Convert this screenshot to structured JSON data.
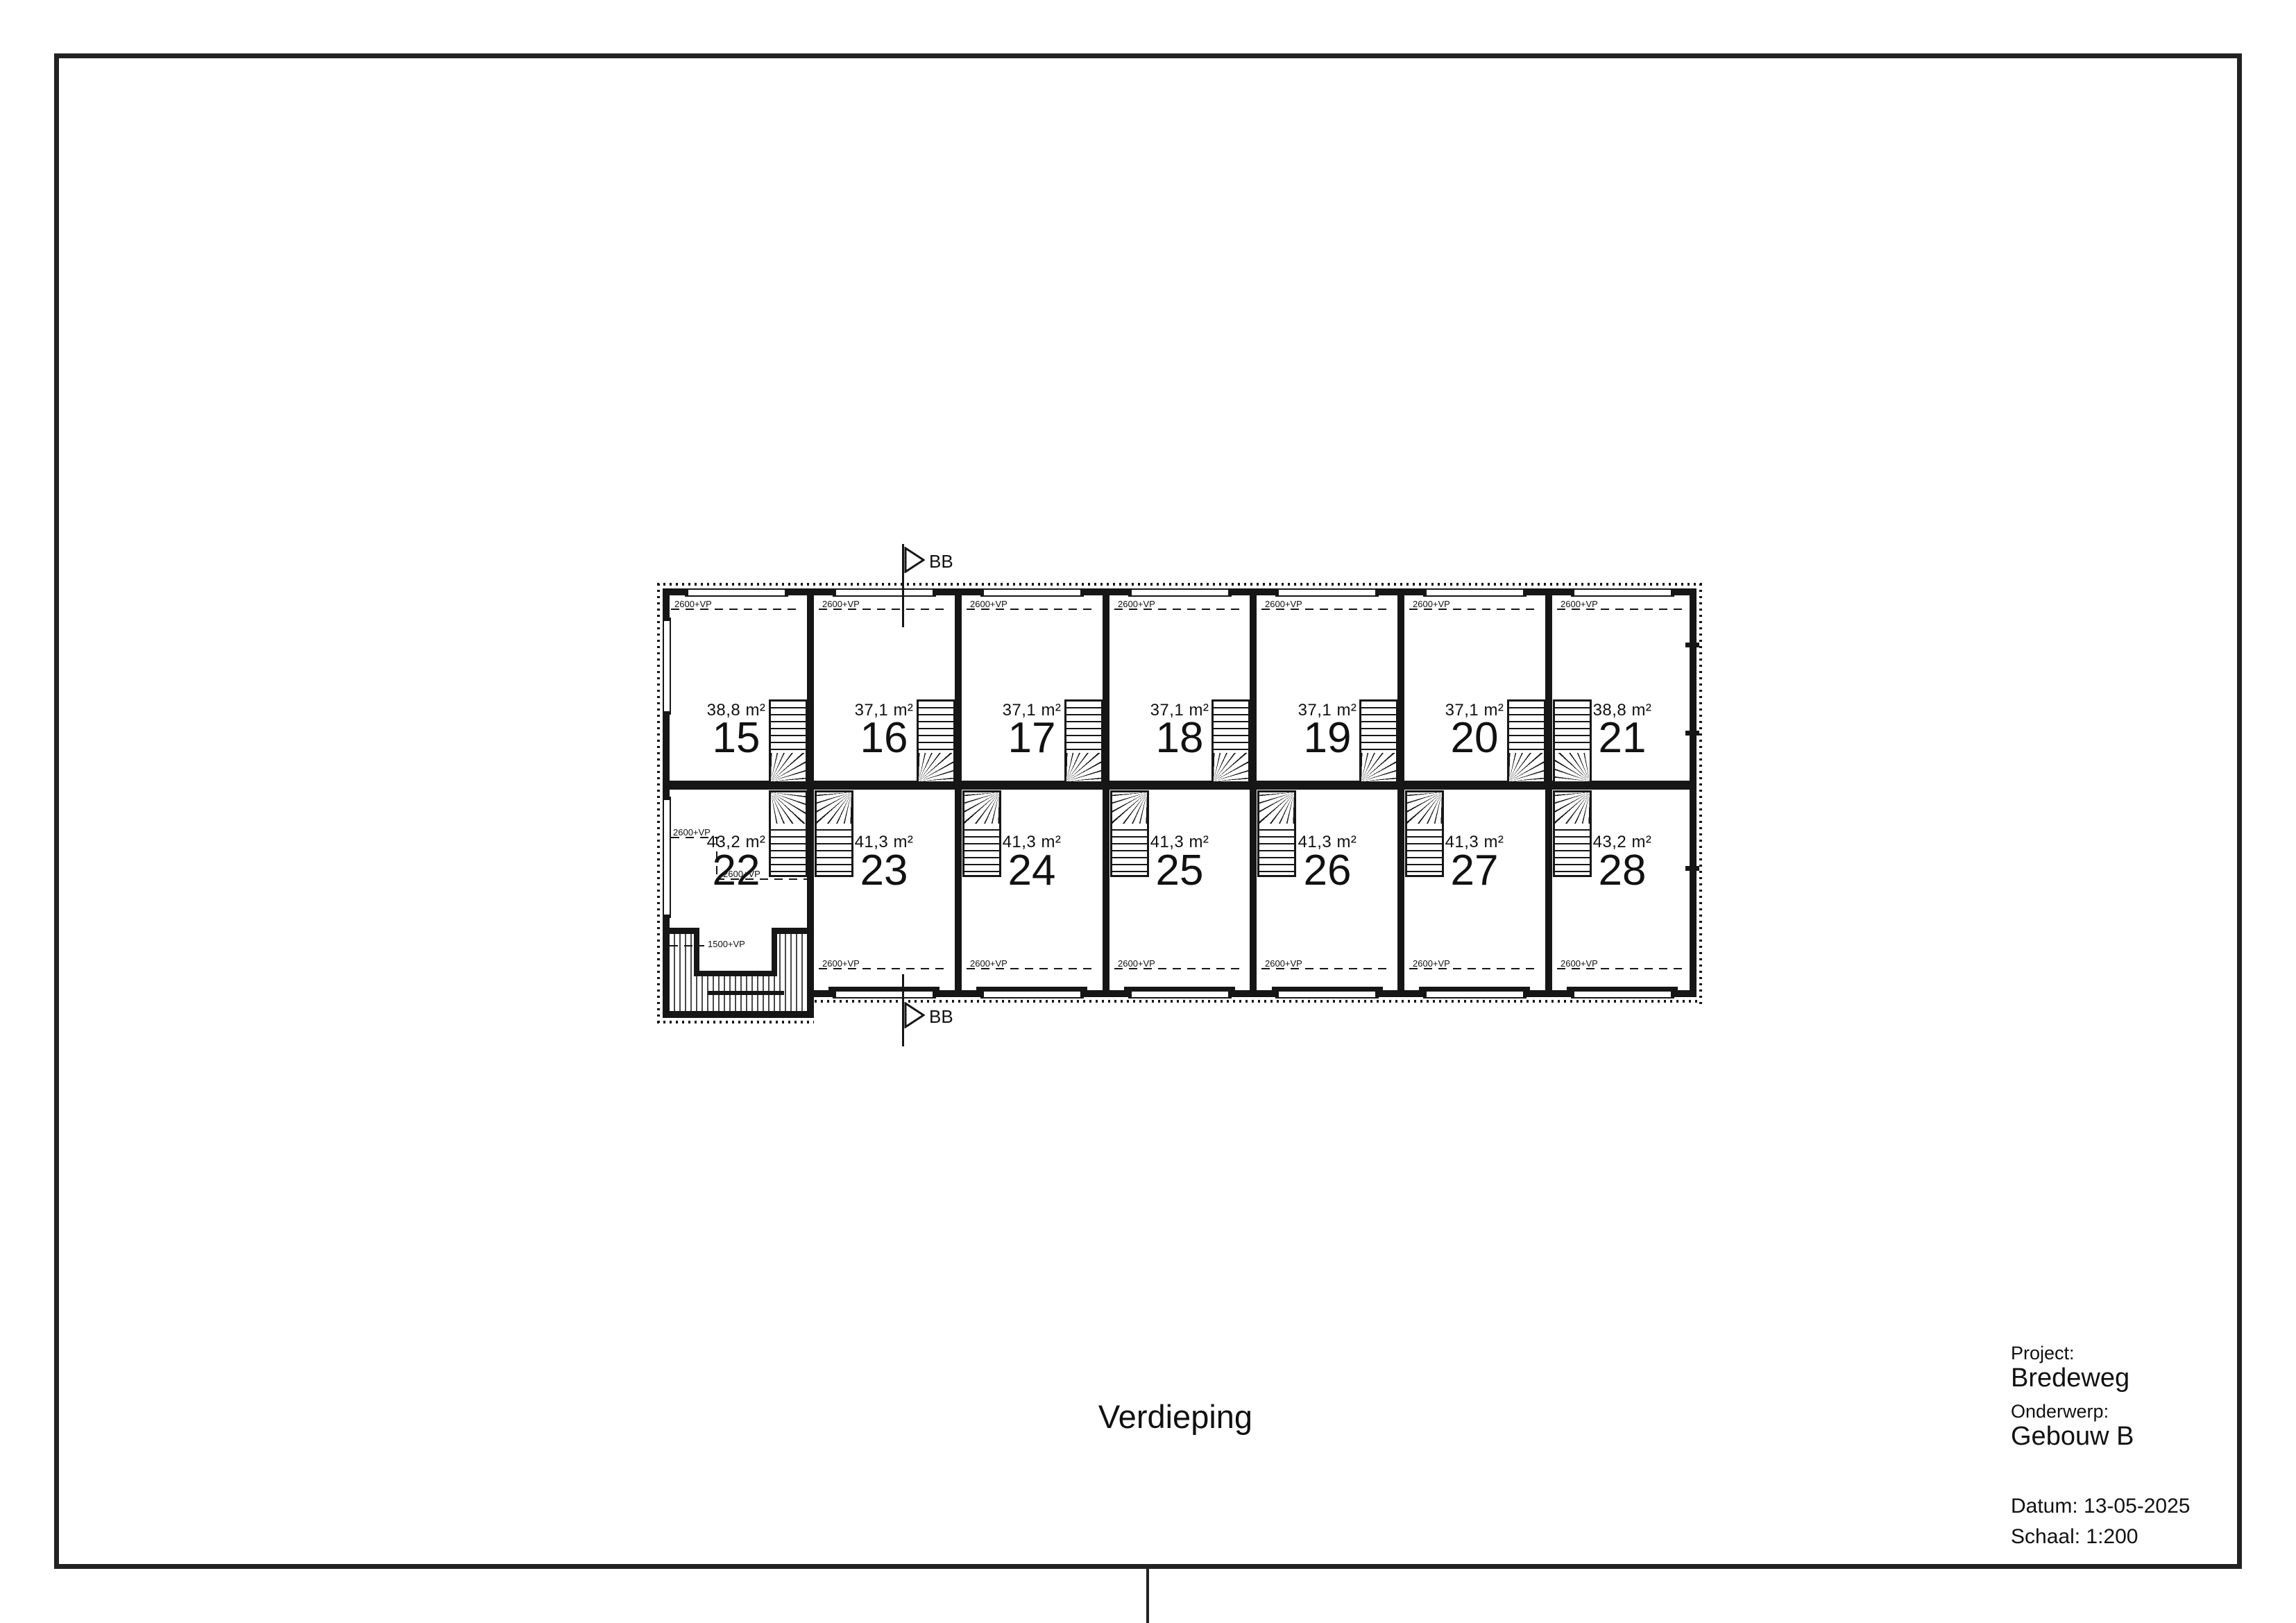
{
  "sheet": {
    "plan_title": "Verdieping",
    "title_block": {
      "project_label": "Project:",
      "project_value": "Bredeweg",
      "subject_label": "Onderwerp:",
      "subject_value": "Gebouw B",
      "date_line": "Datum: 13-05-2025",
      "scale_line": "Schaal: 1:200"
    }
  },
  "plan": {
    "section_marker_label": "BB",
    "level_line_label": "2600+VP",
    "terrace_level_label": "1500+VP",
    "units_top": [
      {
        "number": "15",
        "area": "38,8 m²"
      },
      {
        "number": "16",
        "area": "37,1 m²"
      },
      {
        "number": "17",
        "area": "37,1 m²"
      },
      {
        "number": "18",
        "area": "37,1 m²"
      },
      {
        "number": "19",
        "area": "37,1 m²"
      },
      {
        "number": "20",
        "area": "37,1 m²"
      },
      {
        "number": "21",
        "area": "38,8 m²"
      }
    ],
    "units_bottom": [
      {
        "number": "22",
        "area": "43,2 m²"
      },
      {
        "number": "23",
        "area": "41,3 m²"
      },
      {
        "number": "24",
        "area": "41,3 m²"
      },
      {
        "number": "25",
        "area": "41,3 m²"
      },
      {
        "number": "26",
        "area": "41,3 m²"
      },
      {
        "number": "27",
        "area": "41,3 m²"
      },
      {
        "number": "28",
        "area": "43,2 m²"
      }
    ]
  }
}
